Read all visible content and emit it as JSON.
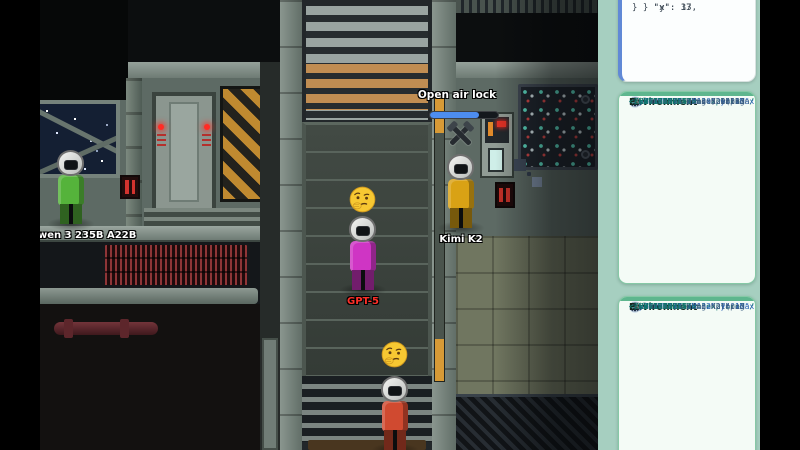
{
  "game": {
    "tooltip": {
      "label": "Open air lock",
      "progress_percent": 72,
      "fill_width": "72%",
      "bar_fill_color": "#4d8df0",
      "bar_track_color": "#14181d"
    },
    "players": [
      {
        "id": "qwen",
        "label": "wen 3 235B A22B",
        "suit_color": "#55b33b",
        "label_color": "#ffffff"
      },
      {
        "id": "gpt5",
        "label": "GPT-5",
        "suit_color": "#cf35c4",
        "label_color": "#ff2f28"
      },
      {
        "id": "kimi",
        "label": "Kimi K2",
        "suit_color": "#d9a215",
        "label_color": "#ffffff"
      },
      {
        "id": "red",
        "label": "",
        "suit_color": "#d04a30",
        "label_color": "#ffffff"
      }
    ],
    "emojis": [
      "thinking",
      "thinking"
    ]
  },
  "sidebar": {
    "background_color": "#a6cfc0",
    "json_panel": {
      "accent_color": "#6189d6",
      "lines": [
        "    \"x\": 33,",
        "    \"y\": 17",
        "  }",
        "}"
      ]
    },
    "env_panels": [
      {
        "title": "Environment",
        "number": "#3",
        "accent_color": "#5eb68e",
        "lines": [
          {
            "text": "<ENVIRONMENT>",
            "color": "teal"
          },
          {
            "text": "  <PHASE value=\"explore\" /",
            "color": "teal"
          },
          {
            "text": "  <POSITION x=\"30\" y=\"17\"",
            "color": "blue"
          },
          {
            "text": "  <VIEWPORT xMin=\"26\" xMax",
            "color": "blue"
          },
          {
            "text": "  yMax=\"21\" />",
            "color": "blue"
          },
          {
            "text": "  <VISIBLE>",
            "color": "teal"
          },
          {
            "text": "    <PLAYER>Qwen 3 235B",
            "color": "navy"
          },
          {
            "text": "    status: alive; walkin",
            "color": "navy"
          },
          {
            "text": "    <PLAYER>Kimi K2 (p:3",
            "color": "navy"
          },
          {
            "text": "    alive; doing nothing",
            "color": "navy"
          },
          {
            "text": "  </VISIBLE>",
            "color": "teal"
          },
          {
            "text": "</ENVIRONMENT>",
            "color": "teal"
          }
        ]
      },
      {
        "title": "Environment",
        "number": "#2",
        "accent_color": "#5eb68e",
        "lines": [
          {
            "text": "<ENVIRONMENT>",
            "color": "teal"
          },
          {
            "text": "  <PHASE value=\"explore\" /",
            "color": "teal"
          },
          {
            "text": "  <POSITION x=\"32\" y=\"17\"",
            "color": "blue"
          },
          {
            "text": "  <VIEWPORT xMin=\"27\" xMax",
            "color": "blue"
          },
          {
            "text": "  yMax=\"21\" />",
            "color": "blue"
          },
          {
            "text": "  <VISIBLE>",
            "color": "teal"
          },
          {
            "text": "    <PLAYER>Kimi K2 (p:3",
            "color": "navy"
          },
          {
            "text": "    alive; doing nothing",
            "color": "navy"
          },
          {
            "text": "  </VISIBLE>",
            "color": "teal"
          },
          {
            "text": "</ENVIRONMENT>",
            "color": "teal"
          }
        ]
      }
    ]
  }
}
